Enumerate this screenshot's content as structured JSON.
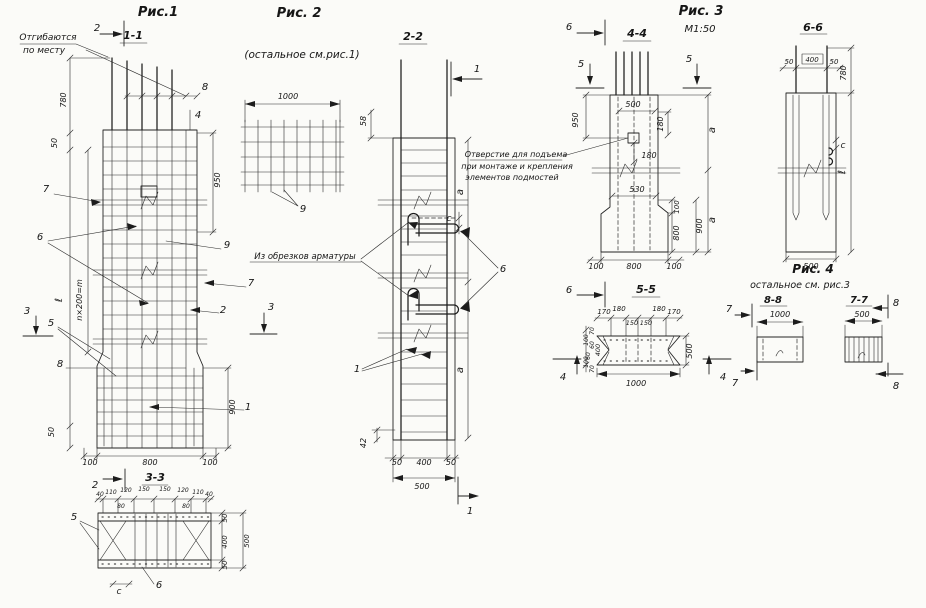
{
  "sheet": {
    "background": "#fbfbf8",
    "ink": "#222222"
  },
  "fig1": {
    "title": "Рис.1",
    "section_mark": "1-1",
    "note_line1": "Отгибаются",
    "note_line2": "по месту",
    "cut2_top": "2",
    "cut2_bottom": "2",
    "cut3_left": "3",
    "cut3_right": "3",
    "dims": {
      "d780": "780",
      "d50_top": "50",
      "d950": "950",
      "d_l": "ℓ",
      "d_spacing": "n×200=m",
      "d900": "900",
      "d50_bottom": "50",
      "d100_left": "100",
      "d800": "800",
      "d100_right": "100"
    },
    "parts": {
      "p8_top": "8",
      "p4": "4",
      "p7_left": "7",
      "p6": "6",
      "p9": "9",
      "p7_right": "7",
      "p2": "2",
      "p5": "5",
      "p8_bottom": "8",
      "p1": "1"
    }
  },
  "sec33": {
    "title": "3-3",
    "top_dims": [
      "40",
      "110",
      "120",
      "150",
      "150",
      "120",
      "110",
      "40"
    ],
    "d80_left": "80",
    "d80_right": "80",
    "d50_top": "50",
    "d400": "400",
    "d50_bottom": "50",
    "d500": "500",
    "p5": "5",
    "dc": "c",
    "p6": "6"
  },
  "fig2": {
    "title": "Рис. 2",
    "subtitle": "(остальное см.рис.1)",
    "d1000": "1000",
    "p9": "9",
    "section_mark": "2-2",
    "cut1_top": "1",
    "cut1_bottom": "1",
    "note": "Из обрезков арматуры",
    "dims": {
      "d58": "58",
      "dc": "c",
      "da_top": "a",
      "da_bottom": "a",
      "d42": "42",
      "d50_left": "50",
      "d400": "400",
      "d50_right": "50",
      "d500": "500"
    },
    "parts": {
      "p6": "6",
      "p1": "1"
    }
  },
  "fig3": {
    "title": "Рис. 3",
    "scale": "М1:50",
    "section_mark": "4-4",
    "cut6_top": "6",
    "cut6_bottom": "6",
    "cut5_left": "5",
    "cut5_right": "5",
    "note_line1": "Отверстие для подъема",
    "note_line2": "при монтаже и крепления",
    "note_line3": "элементов подмостей",
    "dims": {
      "d950": "950",
      "d500": "500",
      "d180_side": "180",
      "d180_below": "180",
      "d530": "530",
      "d100_step": "100",
      "d800_side": "800",
      "d900": "900",
      "da_top": "a",
      "da_bottom": "a",
      "d100_left": "100",
      "d800_bottom": "800",
      "d100_right": "100"
    }
  },
  "sec55": {
    "title": "5-5",
    "top_dims": [
      "170",
      "180",
      "180",
      "170"
    ],
    "mid_dims": [
      "150",
      "150"
    ],
    "left_dims": [
      "70",
      "100",
      "60",
      "400",
      "60",
      "100",
      "70"
    ],
    "d500": "500",
    "d1000": "1000",
    "cut4_left": "4",
    "cut4_right": "4"
  },
  "sec66": {
    "title": "6-6",
    "d50_left": "50",
    "d400": "400",
    "d50_right": "50",
    "d780": "780",
    "dc": "c",
    "d_l": "ℓ",
    "d500": "500"
  },
  "fig4": {
    "title": "Рис. 4",
    "subtitle": "остальное см. рис.3",
    "sec88_title": "8-8",
    "d1000": "1000",
    "sec77_title": "7-7",
    "d500": "500",
    "cut7_top": "7",
    "cut7_bottom": "7",
    "cut8_top": "8",
    "cut8_bottom": "8"
  }
}
